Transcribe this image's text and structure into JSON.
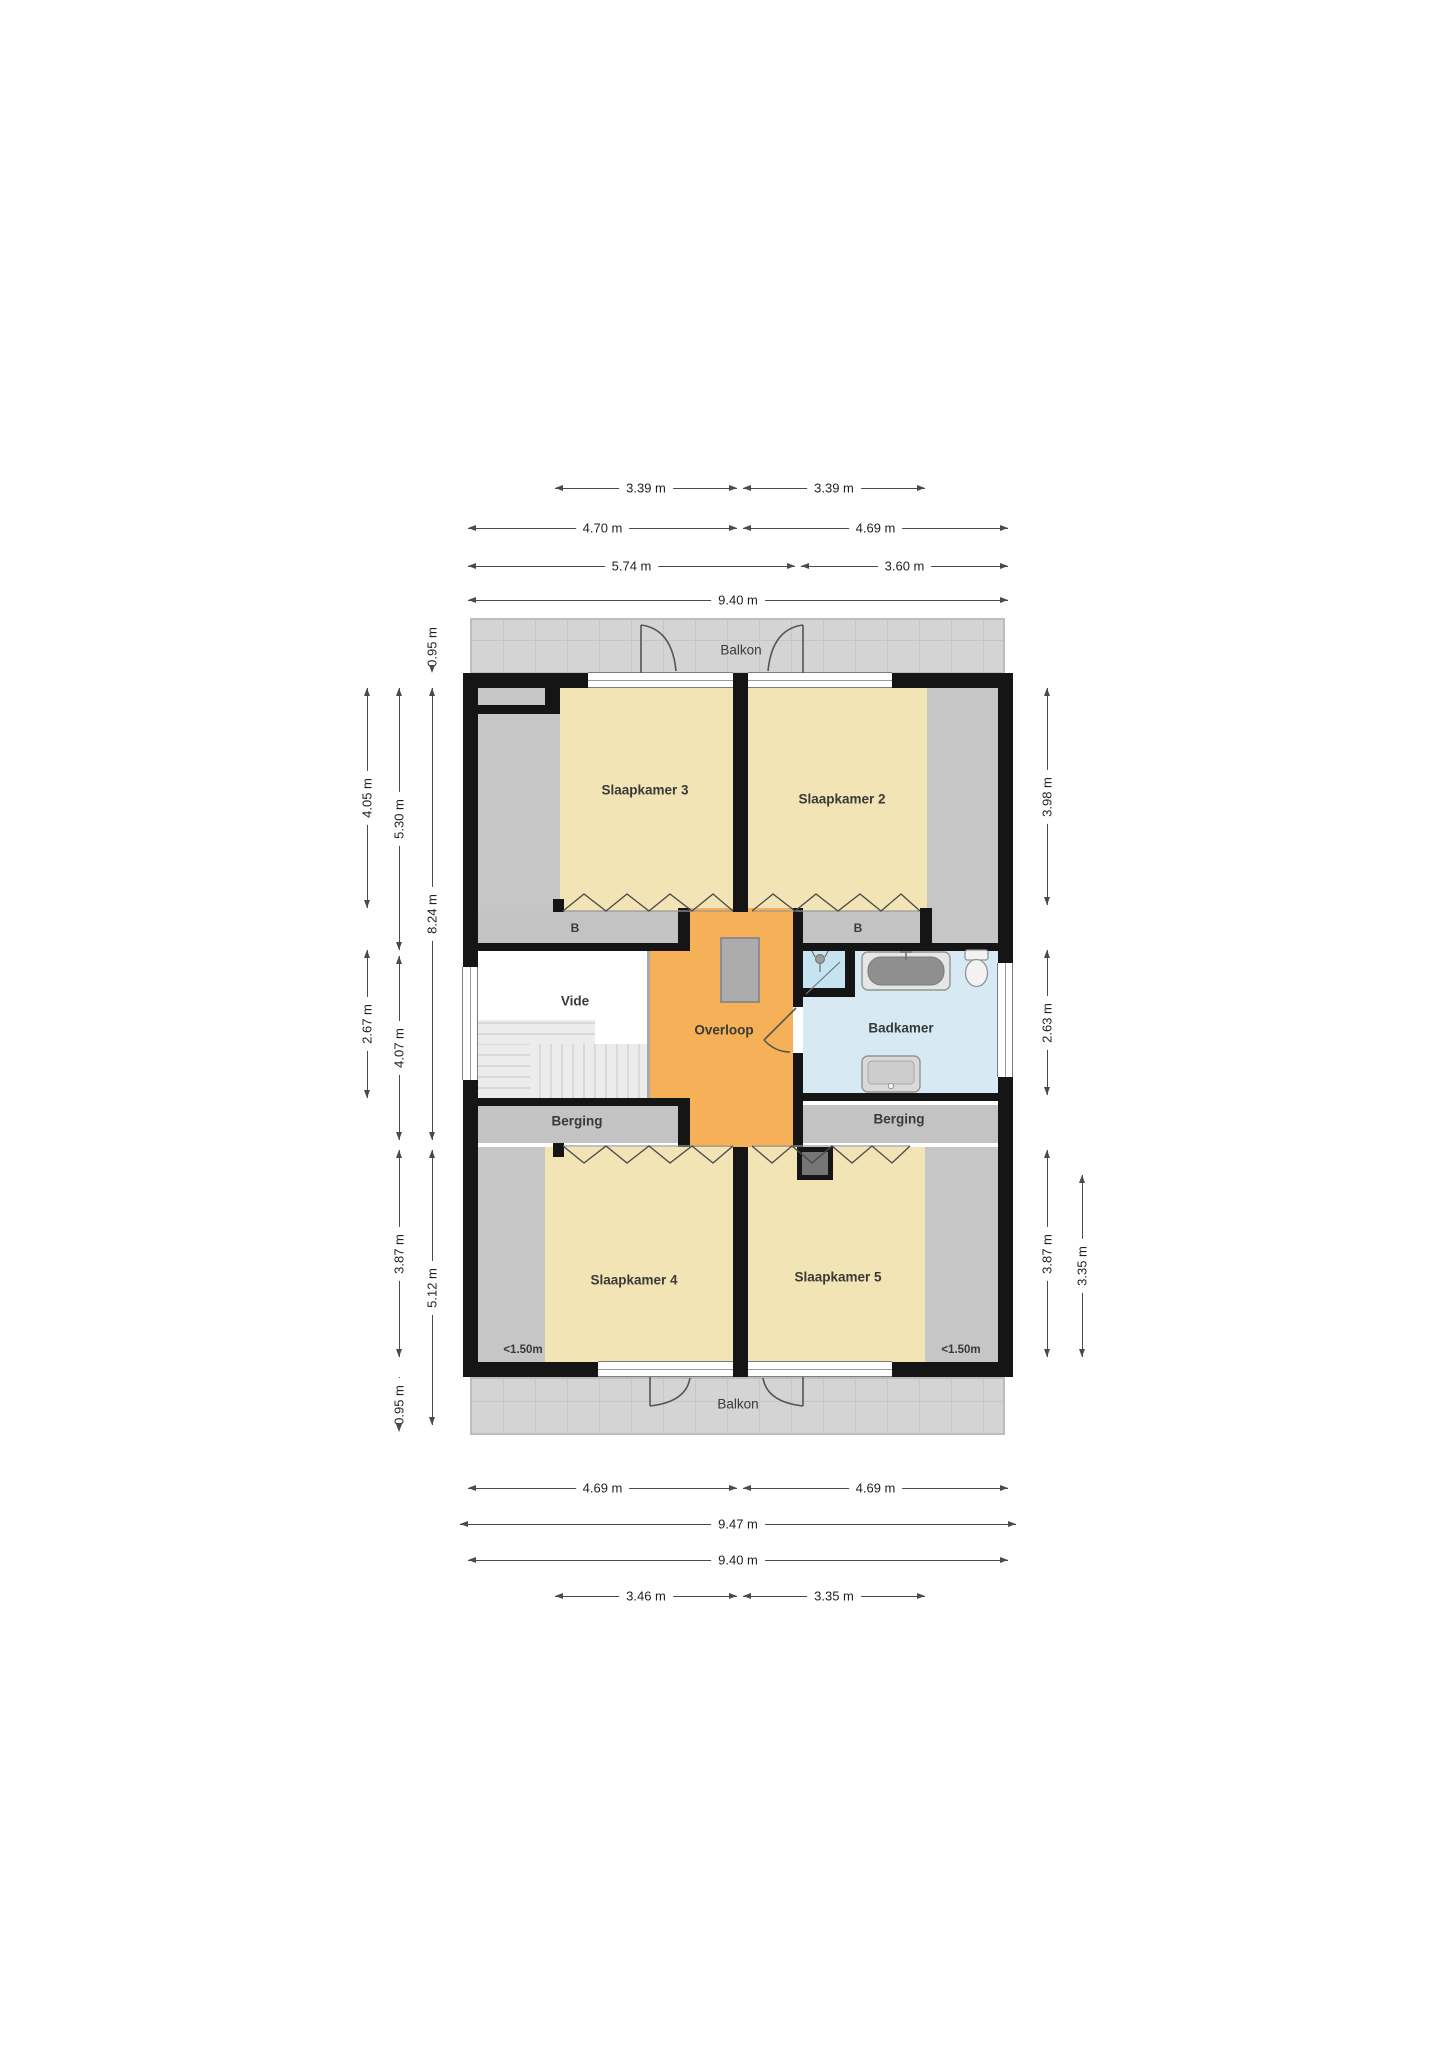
{
  "rooms": {
    "balkon": "Balkon",
    "slaapkamer2": "Slaapkamer 2",
    "slaapkamer3": "Slaapkamer 3",
    "slaapkamer4": "Slaapkamer 4",
    "slaapkamer5": "Slaapkamer 5",
    "vide": "Vide",
    "overloop": "Overloop",
    "badkamer": "Badkamer",
    "berging": "Berging",
    "closet": "B",
    "low_headroom": "<1.50m"
  },
  "dims": {
    "h": [
      "3.39 m",
      "3.39 m",
      "4.70 m",
      "4.69 m",
      "5.74 m",
      "3.60 m",
      "9.40 m",
      "4.69 m",
      "4.69 m",
      "9.47 m",
      "9.40 m",
      "3.46 m",
      "3.35 m"
    ],
    "v": [
      "0.95 m",
      "4.05 m",
      "5.30 m",
      "8.24 m",
      "2.67 m",
      "4.07 m",
      "3.87 m",
      "5.12 m",
      "0.95 m",
      "3.98 m",
      "2.63 m",
      "3.87 m",
      "3.35 m"
    ]
  },
  "colors": {
    "room_cream": "#f3e4b5",
    "hall_orange": "#f6b057",
    "bath_blue": "#d7eaf3",
    "shower_blue": "#c6e3f0",
    "balcony_gray": "#d4d4d4",
    "strip_gray": "#c6c6c6",
    "wall_black": "#151515"
  }
}
